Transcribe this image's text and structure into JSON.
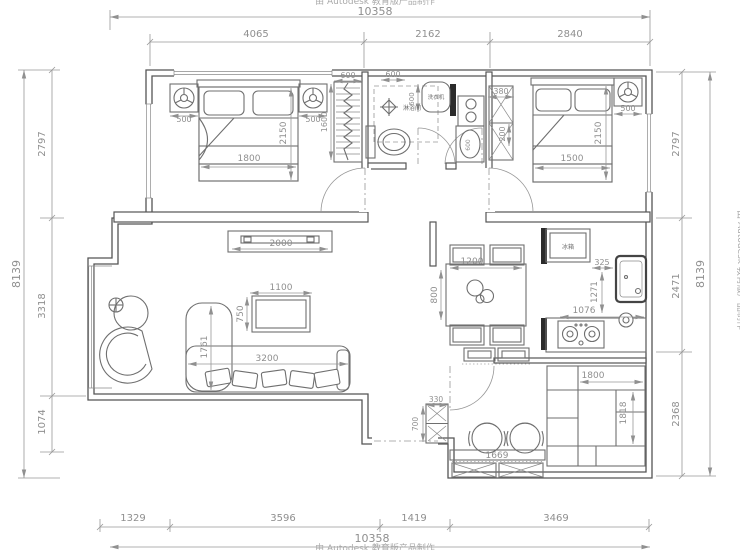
{
  "drawing": {
    "type": "residential floor plan",
    "watermark": "由 Autodesk 教育版产品制作"
  },
  "colors": {
    "background": "#ffffff",
    "walls": "#555555",
    "furniture": "#6f6f6f",
    "dimension_text": "#8f8f8f",
    "solid_wall_fill": "#2b2b2b"
  },
  "dimension_chains": {
    "top": {
      "overall": "10358",
      "segments": [
        "4065",
        "2162",
        "2840"
      ]
    },
    "bottom": {
      "overall": "10358",
      "segments": [
        "1329",
        "3596",
        "1419",
        "3469"
      ]
    },
    "left": {
      "overall": "8139",
      "segments": [
        "2797",
        "3318",
        "1074"
      ]
    },
    "right": {
      "overall": "8139",
      "segments": [
        "2797",
        "2471",
        "2368"
      ]
    }
  },
  "labels": {
    "shower": "淋浴间",
    "washing_machine": "洗衣机",
    "fridge": "冰箱"
  },
  "annotations": [
    {
      "n": "dim-top-overall",
      "t": "10358",
      "x": 375,
      "y": 15,
      "s": 11
    },
    {
      "n": "dim-top-seg-1",
      "t": "4065",
      "x": 256,
      "y": 37,
      "s": 10
    },
    {
      "n": "dim-top-seg-2",
      "t": "2162",
      "x": 428,
      "y": 37,
      "s": 10
    },
    {
      "n": "dim-top-seg-3",
      "t": "2840",
      "x": 570,
      "y": 37,
      "s": 10
    },
    {
      "n": "dim-bottom-seg-1",
      "t": "1329",
      "x": 133,
      "y": 521,
      "s": 10
    },
    {
      "n": "dim-bottom-seg-2",
      "t": "3596",
      "x": 283,
      "y": 521,
      "s": 10
    },
    {
      "n": "dim-bottom-seg-3",
      "t": "1419",
      "x": 414,
      "y": 521,
      "s": 10
    },
    {
      "n": "dim-bottom-seg-4",
      "t": "3469",
      "x": 556,
      "y": 521,
      "s": 10
    },
    {
      "n": "dim-bottom-overall",
      "t": "10358",
      "x": 372,
      "y": 542,
      "s": 11
    },
    {
      "n": "dim-left-overall",
      "t": "8139",
      "x": 20,
      "y": 274,
      "r": -90,
      "s": 11
    },
    {
      "n": "dim-left-seg-1",
      "t": "2797",
      "x": 45,
      "y": 144,
      "r": -90,
      "s": 10
    },
    {
      "n": "dim-left-seg-2",
      "t": "3318",
      "x": 45,
      "y": 306,
      "r": -90,
      "s": 10
    },
    {
      "n": "dim-left-seg-3",
      "t": "1074",
      "x": 45,
      "y": 422,
      "r": -90,
      "s": 10
    },
    {
      "n": "dim-right-seg-1",
      "t": "2797",
      "x": 679,
      "y": 144,
      "r": -90,
      "s": 10
    },
    {
      "n": "dim-right-seg-2",
      "t": "2471",
      "x": 679,
      "y": 286,
      "r": -90,
      "s": 10
    },
    {
      "n": "dim-right-seg-3",
      "t": "2368",
      "x": 679,
      "y": 414,
      "r": -90,
      "s": 10
    },
    {
      "n": "dim-right-overall",
      "t": "8139",
      "x": 704,
      "y": 274,
      "r": -90,
      "s": 11
    },
    {
      "n": "dim-nightstand-left",
      "t": "500",
      "x": 184,
      "y": 122,
      "s": 8
    },
    {
      "n": "dim-nightstand-right",
      "t": "500",
      "x": 313,
      "y": 122,
      "s": 8
    },
    {
      "n": "dim-bed1-width",
      "t": "1800",
      "x": 249,
      "y": 161,
      "s": 9
    },
    {
      "n": "dim-bed1-length",
      "t": "2150",
      "x": 286,
      "y": 133,
      "r": -90,
      "s": 9
    },
    {
      "n": "dim-shoe-rack-width",
      "t": "600",
      "x": 348,
      "y": 78,
      "s": 8
    },
    {
      "n": "dim-shoe-rack-height",
      "t": "1600",
      "x": 327,
      "y": 122,
      "r": -90,
      "s": 8
    },
    {
      "n": "dim-bath-niche",
      "t": "600",
      "x": 393,
      "y": 77,
      "s": 8
    },
    {
      "n": "label-shower",
      "t": "淋浴间",
      "x": 412,
      "y": 110,
      "s": 6,
      "c": "cn"
    },
    {
      "n": "label-washing-machine",
      "t": "洗衣机",
      "x": 436,
      "y": 99,
      "s": 5.5,
      "c": "cn"
    },
    {
      "n": "dim-washer",
      "t": "600",
      "x": 414,
      "y": 99,
      "r": -90,
      "s": 7
    },
    {
      "n": "dim-basin",
      "t": "600",
      "x": 470,
      "y": 145,
      "r": -90,
      "s": 6
    },
    {
      "n": "dim-closet2-width",
      "t": "380",
      "x": 501,
      "y": 94,
      "s": 8
    },
    {
      "n": "dim-closet2-depth",
      "t": "200",
      "x": 505,
      "y": 134,
      "r": -90,
      "s": 8
    },
    {
      "n": "dim-bed2-width",
      "t": "1500",
      "x": 572,
      "y": 161,
      "s": 9
    },
    {
      "n": "dim-bed2-length",
      "t": "2150",
      "x": 601,
      "y": 133,
      "r": -90,
      "s": 9
    },
    {
      "n": "dim-nightstand2",
      "t": "500",
      "x": 628,
      "y": 111,
      "s": 8
    },
    {
      "n": "dim-tv-cabinet",
      "t": "2000",
      "x": 281,
      "y": 246,
      "s": 9
    },
    {
      "n": "dim-coffee-table-w",
      "t": "1100",
      "x": 281,
      "y": 290,
      "s": 9
    },
    {
      "n": "dim-coffee-table-d",
      "t": "750",
      "x": 243,
      "y": 314,
      "r": -90,
      "s": 9
    },
    {
      "n": "dim-sofa-width",
      "t": "3200",
      "x": 267,
      "y": 361,
      "s": 9
    },
    {
      "n": "dim-sofa-depth",
      "t": "1761",
      "x": 207,
      "y": 347,
      "r": -90,
      "s": 9
    },
    {
      "n": "dim-dining-table-w",
      "t": "1200",
      "x": 472,
      "y": 264,
      "s": 9
    },
    {
      "n": "dim-dining-table-d",
      "t": "800",
      "x": 437,
      "y": 295,
      "r": -90,
      "s": 9
    },
    {
      "n": "label-fridge",
      "t": "冰箱",
      "x": 568,
      "y": 249,
      "s": 6,
      "c": "cn"
    },
    {
      "n": "dim-kitchen-offset",
      "t": "325",
      "x": 602,
      "y": 265,
      "s": 8
    },
    {
      "n": "dim-kitchen-depth",
      "t": "1271",
      "x": 597,
      "y": 292,
      "r": -90,
      "s": 8.5
    },
    {
      "n": "dim-kitchen-width",
      "t": "1076",
      "x": 584,
      "y": 313,
      "s": 9
    },
    {
      "n": "dim-shelf-width",
      "t": "1800",
      "x": 593,
      "y": 378,
      "s": 9
    },
    {
      "n": "dim-shelf-height",
      "t": "1818",
      "x": 626,
      "y": 413,
      "r": -90,
      "s": 9
    },
    {
      "n": "dim-counter",
      "t": "1669",
      "x": 497,
      "y": 458,
      "s": 9
    },
    {
      "n": "dim-entry-cabinet-w",
      "t": "330",
      "x": 436,
      "y": 402,
      "s": 7.5
    },
    {
      "n": "dim-entry-cabinet-h",
      "t": "700",
      "x": 418,
      "y": 424,
      "r": -90,
      "s": 7.5
    },
    {
      "n": "watermark-top",
      "t": "由 Autodesk 教育版产品制作",
      "x": 375,
      "y": 4,
      "s": 9,
      "c": "wm"
    },
    {
      "n": "watermark-bottom",
      "t": "由 Autodesk 教育版产品制作",
      "x": 375,
      "y": 551,
      "s": 9,
      "c": "wm"
    },
    {
      "n": "watermark-right",
      "t": "由 Autodesk 教育版产品制作",
      "x": 738,
      "y": 270,
      "r": 90,
      "s": 9,
      "c": "wm"
    }
  ]
}
